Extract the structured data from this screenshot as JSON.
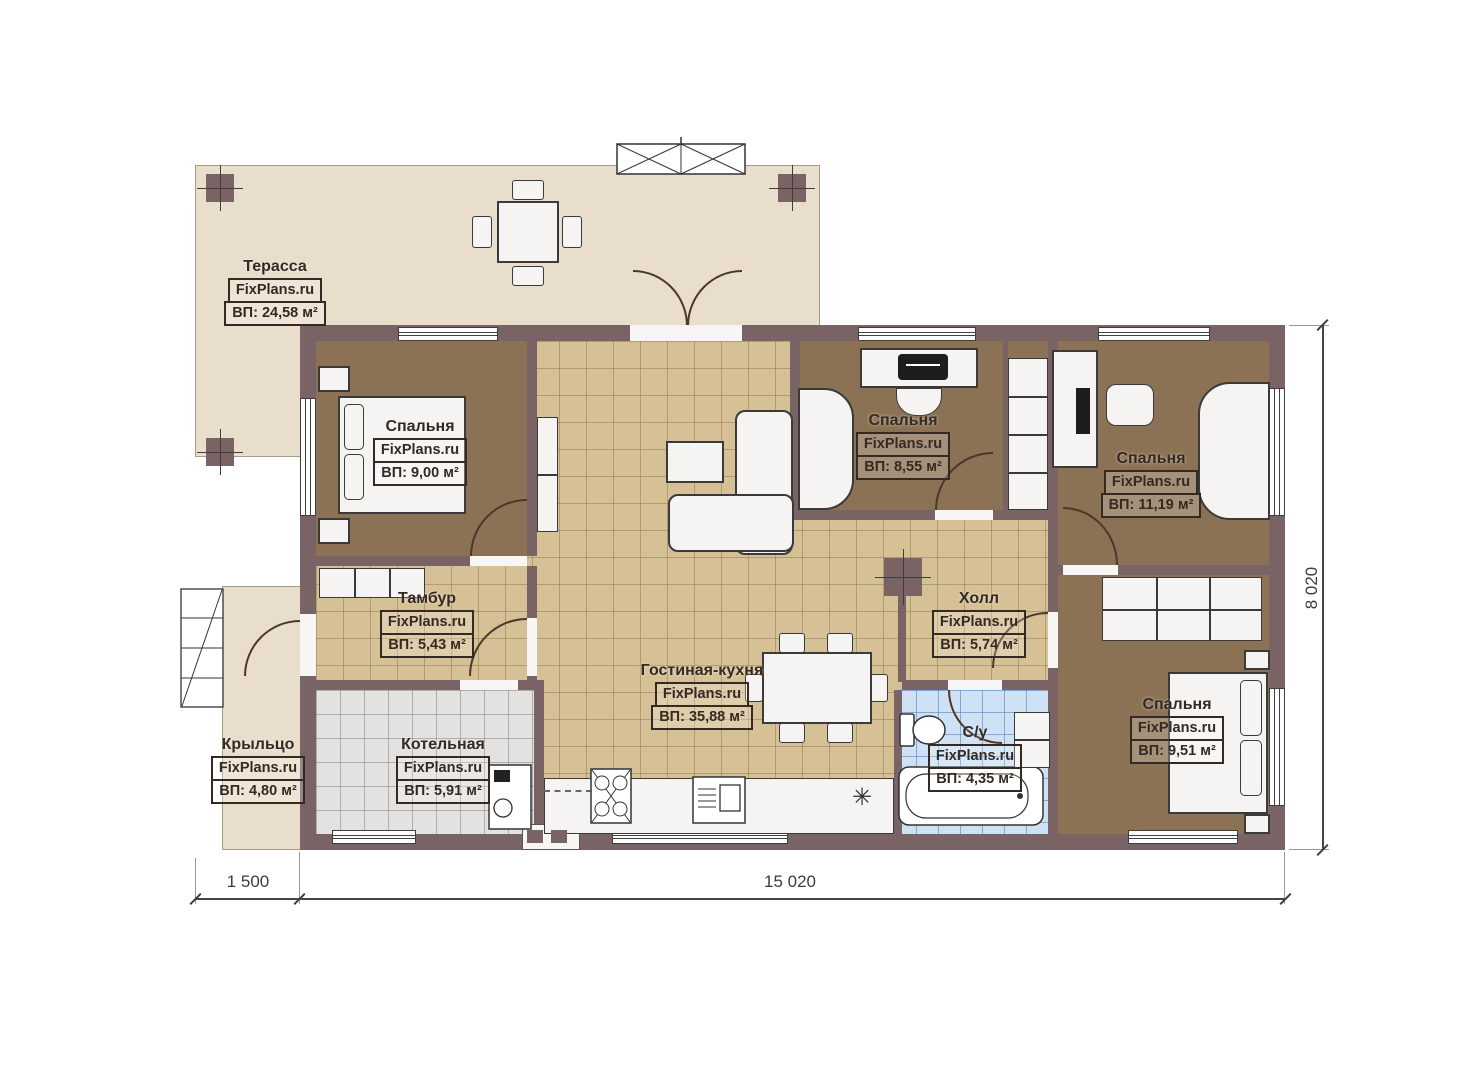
{
  "watermark": "FixPlans.ru",
  "rooms": {
    "terrace": {
      "name": "Терасса",
      "area": "ВП: 24,58 м²"
    },
    "bedroom1": {
      "name": "Спальня",
      "area": "ВП: 9,00 м²"
    },
    "tambour": {
      "name": "Тамбур",
      "area": "ВП: 5,43 м²"
    },
    "living_kitchen": {
      "name": "Гостиная-кухня",
      "area": "ВП: 35,88 м²"
    },
    "boiler": {
      "name": "Котельная",
      "area": "ВП: 5,91 м²"
    },
    "porch": {
      "name": "Крыльцо",
      "area": "ВП: 4,80 м²"
    },
    "bedroom2": {
      "name": "Спальня",
      "area": "ВП: 8,55 м²"
    },
    "hall": {
      "name": "Холл",
      "area": "ВП: 5,74 м²"
    },
    "bathroom": {
      "name": "С/у",
      "area": "ВП: 4,35 м²"
    },
    "bedroom3": {
      "name": "Спальня",
      "area": "ВП: 11,19 м²"
    },
    "bedroom4": {
      "name": "Спальня",
      "area": "ВП: 9,51 м²"
    }
  },
  "dimensions": {
    "porch_width": "1 500",
    "house_width": "15 020",
    "house_depth": "8 020"
  },
  "icons": {
    "fridge": "✳"
  },
  "colors": {
    "wall": "#7a6364",
    "bedroom_floor": "#8c7254",
    "tile_floor": "#d6c095",
    "terrace_floor": "#e9decb",
    "boiler_floor": "#e3e2e0",
    "bathroom_floor": "#cfe2f5"
  }
}
